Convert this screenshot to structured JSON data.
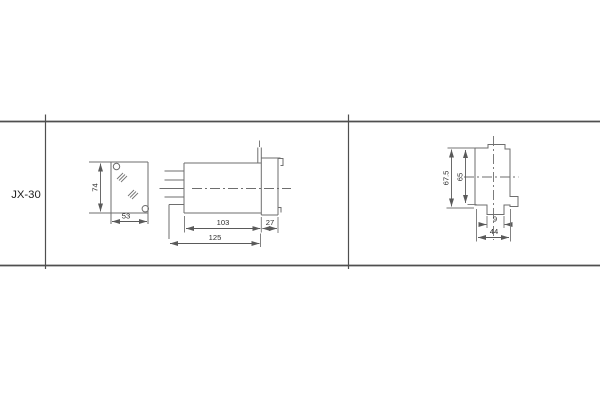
{
  "page": {
    "background": "#ffffff"
  },
  "table": {
    "row_label": "JX-30",
    "rule_color": "#4f4f4f"
  },
  "drawing": {
    "line_color": "#6e6e6e",
    "text_color": "#2e2e2e"
  },
  "views": {
    "front": {
      "label_height": "74",
      "label_width": "53"
    },
    "side": {
      "label_body": "103",
      "label_flange": "27",
      "label_overall": "125"
    },
    "rear": {
      "label_overall_height": "67.5",
      "label_body_height": "65",
      "label_slot": "9",
      "label_width": "44"
    }
  }
}
